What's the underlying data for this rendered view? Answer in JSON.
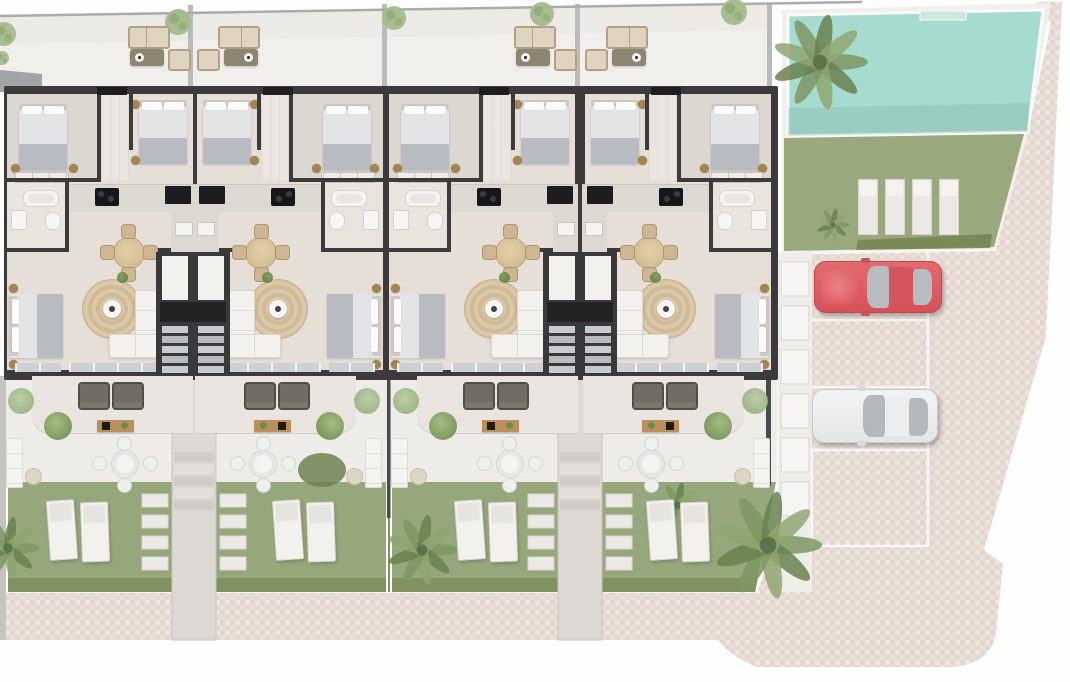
{
  "scene": {
    "kind": "residential site floor plan rendering (top view)",
    "units_count": 4,
    "unit_layout": "two mirrored pairs sharing central stair cores",
    "rooms_per_unit": [
      "bedroom-top",
      "bedroom-inner",
      "bathroom",
      "kitchen",
      "dining-area",
      "living-room",
      "bedroom-lower"
    ],
    "roof_terrace": {
      "per_unit_furniture": [
        "outdoor-sofa",
        "coffee-table",
        "armchair"
      ],
      "trees": 4
    },
    "ground_terrace": {
      "per_unit_furniture": [
        "armchair",
        "armchair",
        "console-table",
        "dining-table",
        "corner-sofa",
        "pouf"
      ],
      "chairs_per_dining": 4
    },
    "garden": {
      "loungers_per_unit": 2,
      "stepping_stone_rows": 4,
      "walkways": 2,
      "walkway_treads": 5
    },
    "pool_area": {
      "pool": true,
      "pool_ladder": true,
      "lawn": true,
      "lawn_loungers": 4,
      "palm_trees": 2
    },
    "parking": {
      "marked_spaces": 4,
      "cars": [
        {
          "name": "red-car",
          "space_index": 1
        },
        {
          "name": "white-car",
          "space_index": 3
        }
      ]
    },
    "other": [
      "paver-plaza",
      "sidewalk",
      "boundary-line",
      "large-palm-tree",
      "garden-palms",
      "stair-cores"
    ]
  },
  "palette": {
    "wall": "#3c3a3b",
    "floor": "#e5dfd8",
    "floorBed": "#dcd7d1",
    "floorBath": "#e9e4dd",
    "floorHall": "#eae5e0",
    "headboard": "#cfc9c1",
    "duvet": "#e2e4e6",
    "blanket": "#b8bcc2",
    "stool": "#a5854f",
    "counter": "#dcd8d2",
    "chairTan": "#cdb691",
    "cushion": "#ded4c0",
    "rattan": "#b2a184",
    "wood": "#b9905c",
    "terrace": "#f1efec",
    "groundTerrace": "#edece9",
    "walkway": "#dcd9d5",
    "stone": "#eceae6",
    "garden": "#96a77c",
    "hedge": "#7d905e",
    "lawn": "#9aa87e",
    "lawnHedge": "#74854f",
    "pool": "#a6dccf",
    "poolDeck": "#f2f0ed",
    "paverBase": "#e9ded8",
    "paverDark": "#e0d1ca",
    "paverLight": "#efe7e1",
    "lineWhite": "#f7f6f4",
    "boundary": "#a9acab",
    "fence": "#4a4a4c",
    "carRed": "#dd5a60",
    "carWhite": "#f0f1f1",
    "glass": "#b6bbbf",
    "palm": "#7d9663",
    "palmDark": "#68814f",
    "palmLight": "#8fa671",
    "tree": "#a4bc8c"
  },
  "counts": {
    "pool_loungers": 4,
    "stepping_stones_per_column": 4,
    "stair_treads": 5,
    "walkway_treads": 5,
    "strip_cells": 6,
    "wall_cells_note": "service strip cells between building and parking"
  }
}
